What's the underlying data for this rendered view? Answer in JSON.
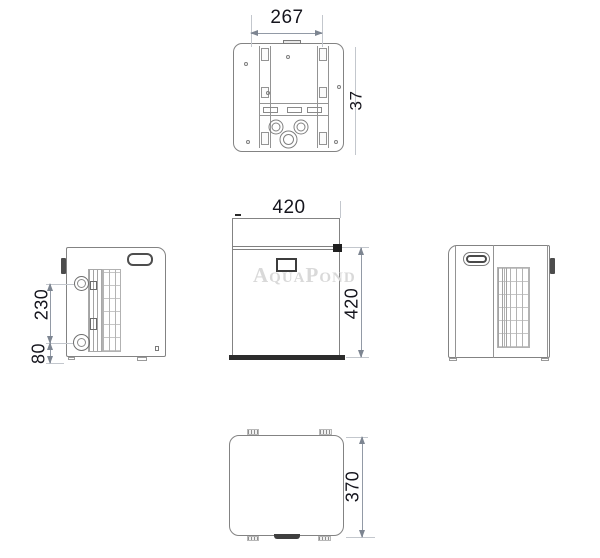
{
  "drawing": {
    "watermark": "AquaPond",
    "dimensions": {
      "top_width": "267",
      "top_depth": "37",
      "front_width": "420",
      "front_height": "420",
      "side_port_spacing": "230",
      "side_port_offset": "80",
      "bottom_depth": "370"
    }
  }
}
